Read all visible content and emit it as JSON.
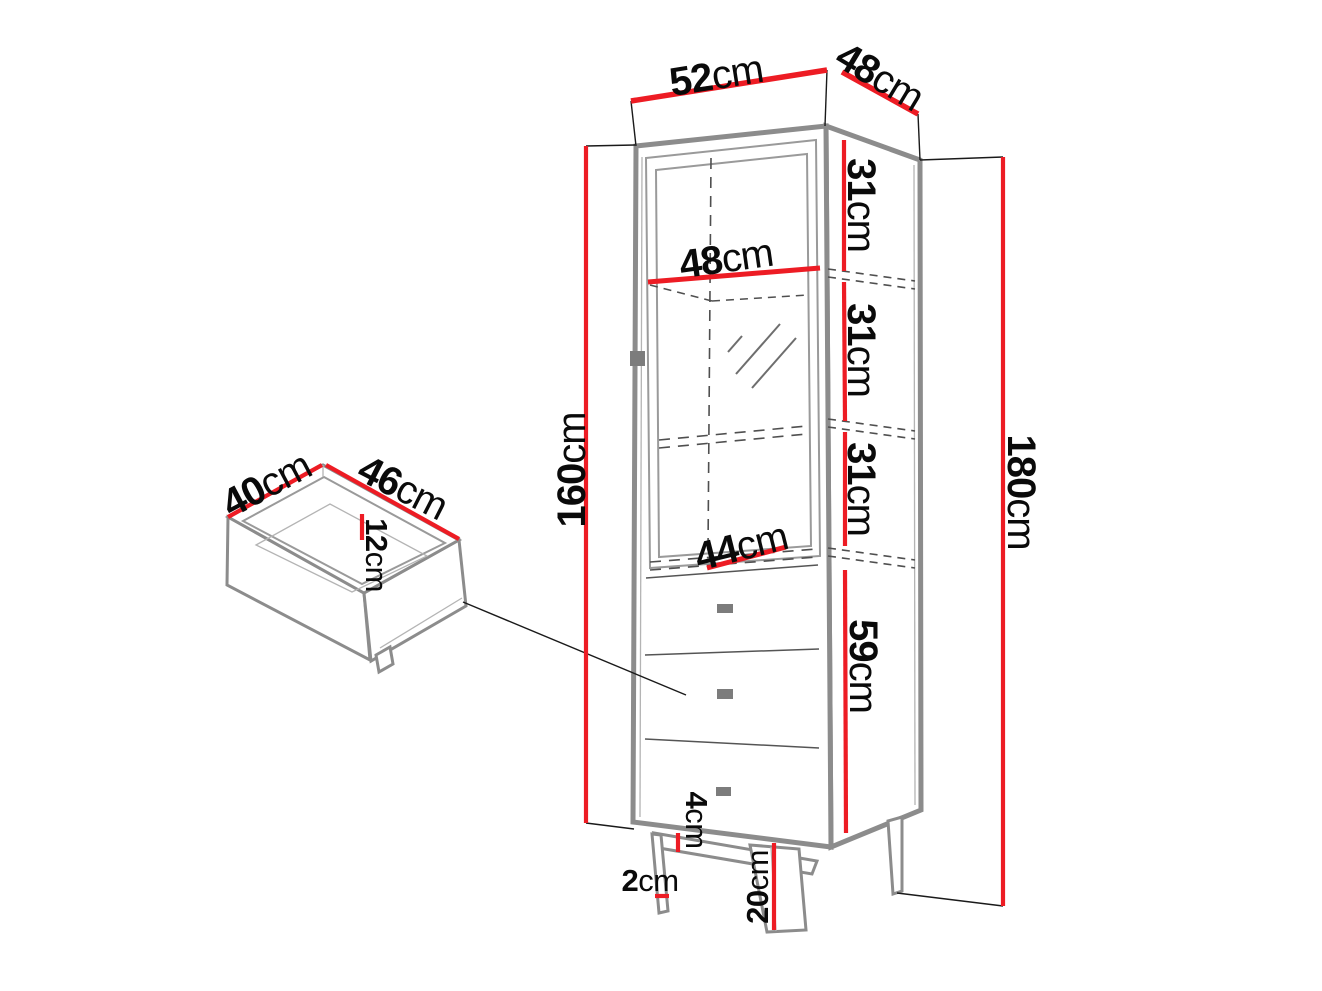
{
  "colors": {
    "dimension_red": "#ed1c24",
    "outline_gray": "#8c8c8c",
    "text": "#0a0a0a",
    "background": "#ffffff"
  },
  "dimensions": {
    "top_width": {
      "value": "52",
      "unit": "cm"
    },
    "top_depth": {
      "value": "48",
      "unit": "cm"
    },
    "interior_width": {
      "value": "48",
      "unit": "cm"
    },
    "section_top": {
      "value": "31",
      "unit": "cm"
    },
    "section_middle": {
      "value": "31",
      "unit": "cm"
    },
    "section_bottom": {
      "value": "31",
      "unit": "cm"
    },
    "interior_bottom_width": {
      "value": "44",
      "unit": "cm"
    },
    "drawer_section_height": {
      "value": "59",
      "unit": "cm"
    },
    "body_height_left": {
      "value": "160",
      "unit": "cm"
    },
    "total_height_right": {
      "value": "180",
      "unit": "cm"
    },
    "plinth_height": {
      "value": "4",
      "unit": "cm"
    },
    "leg_thickness": {
      "value": "2",
      "unit": "cm"
    },
    "leg_height": {
      "value": "20",
      "unit": "cm"
    },
    "drawer_depth": {
      "value": "40",
      "unit": "cm"
    },
    "drawer_width": {
      "value": "46",
      "unit": "cm"
    },
    "drawer_height": {
      "value": "12",
      "unit": "cm"
    }
  }
}
